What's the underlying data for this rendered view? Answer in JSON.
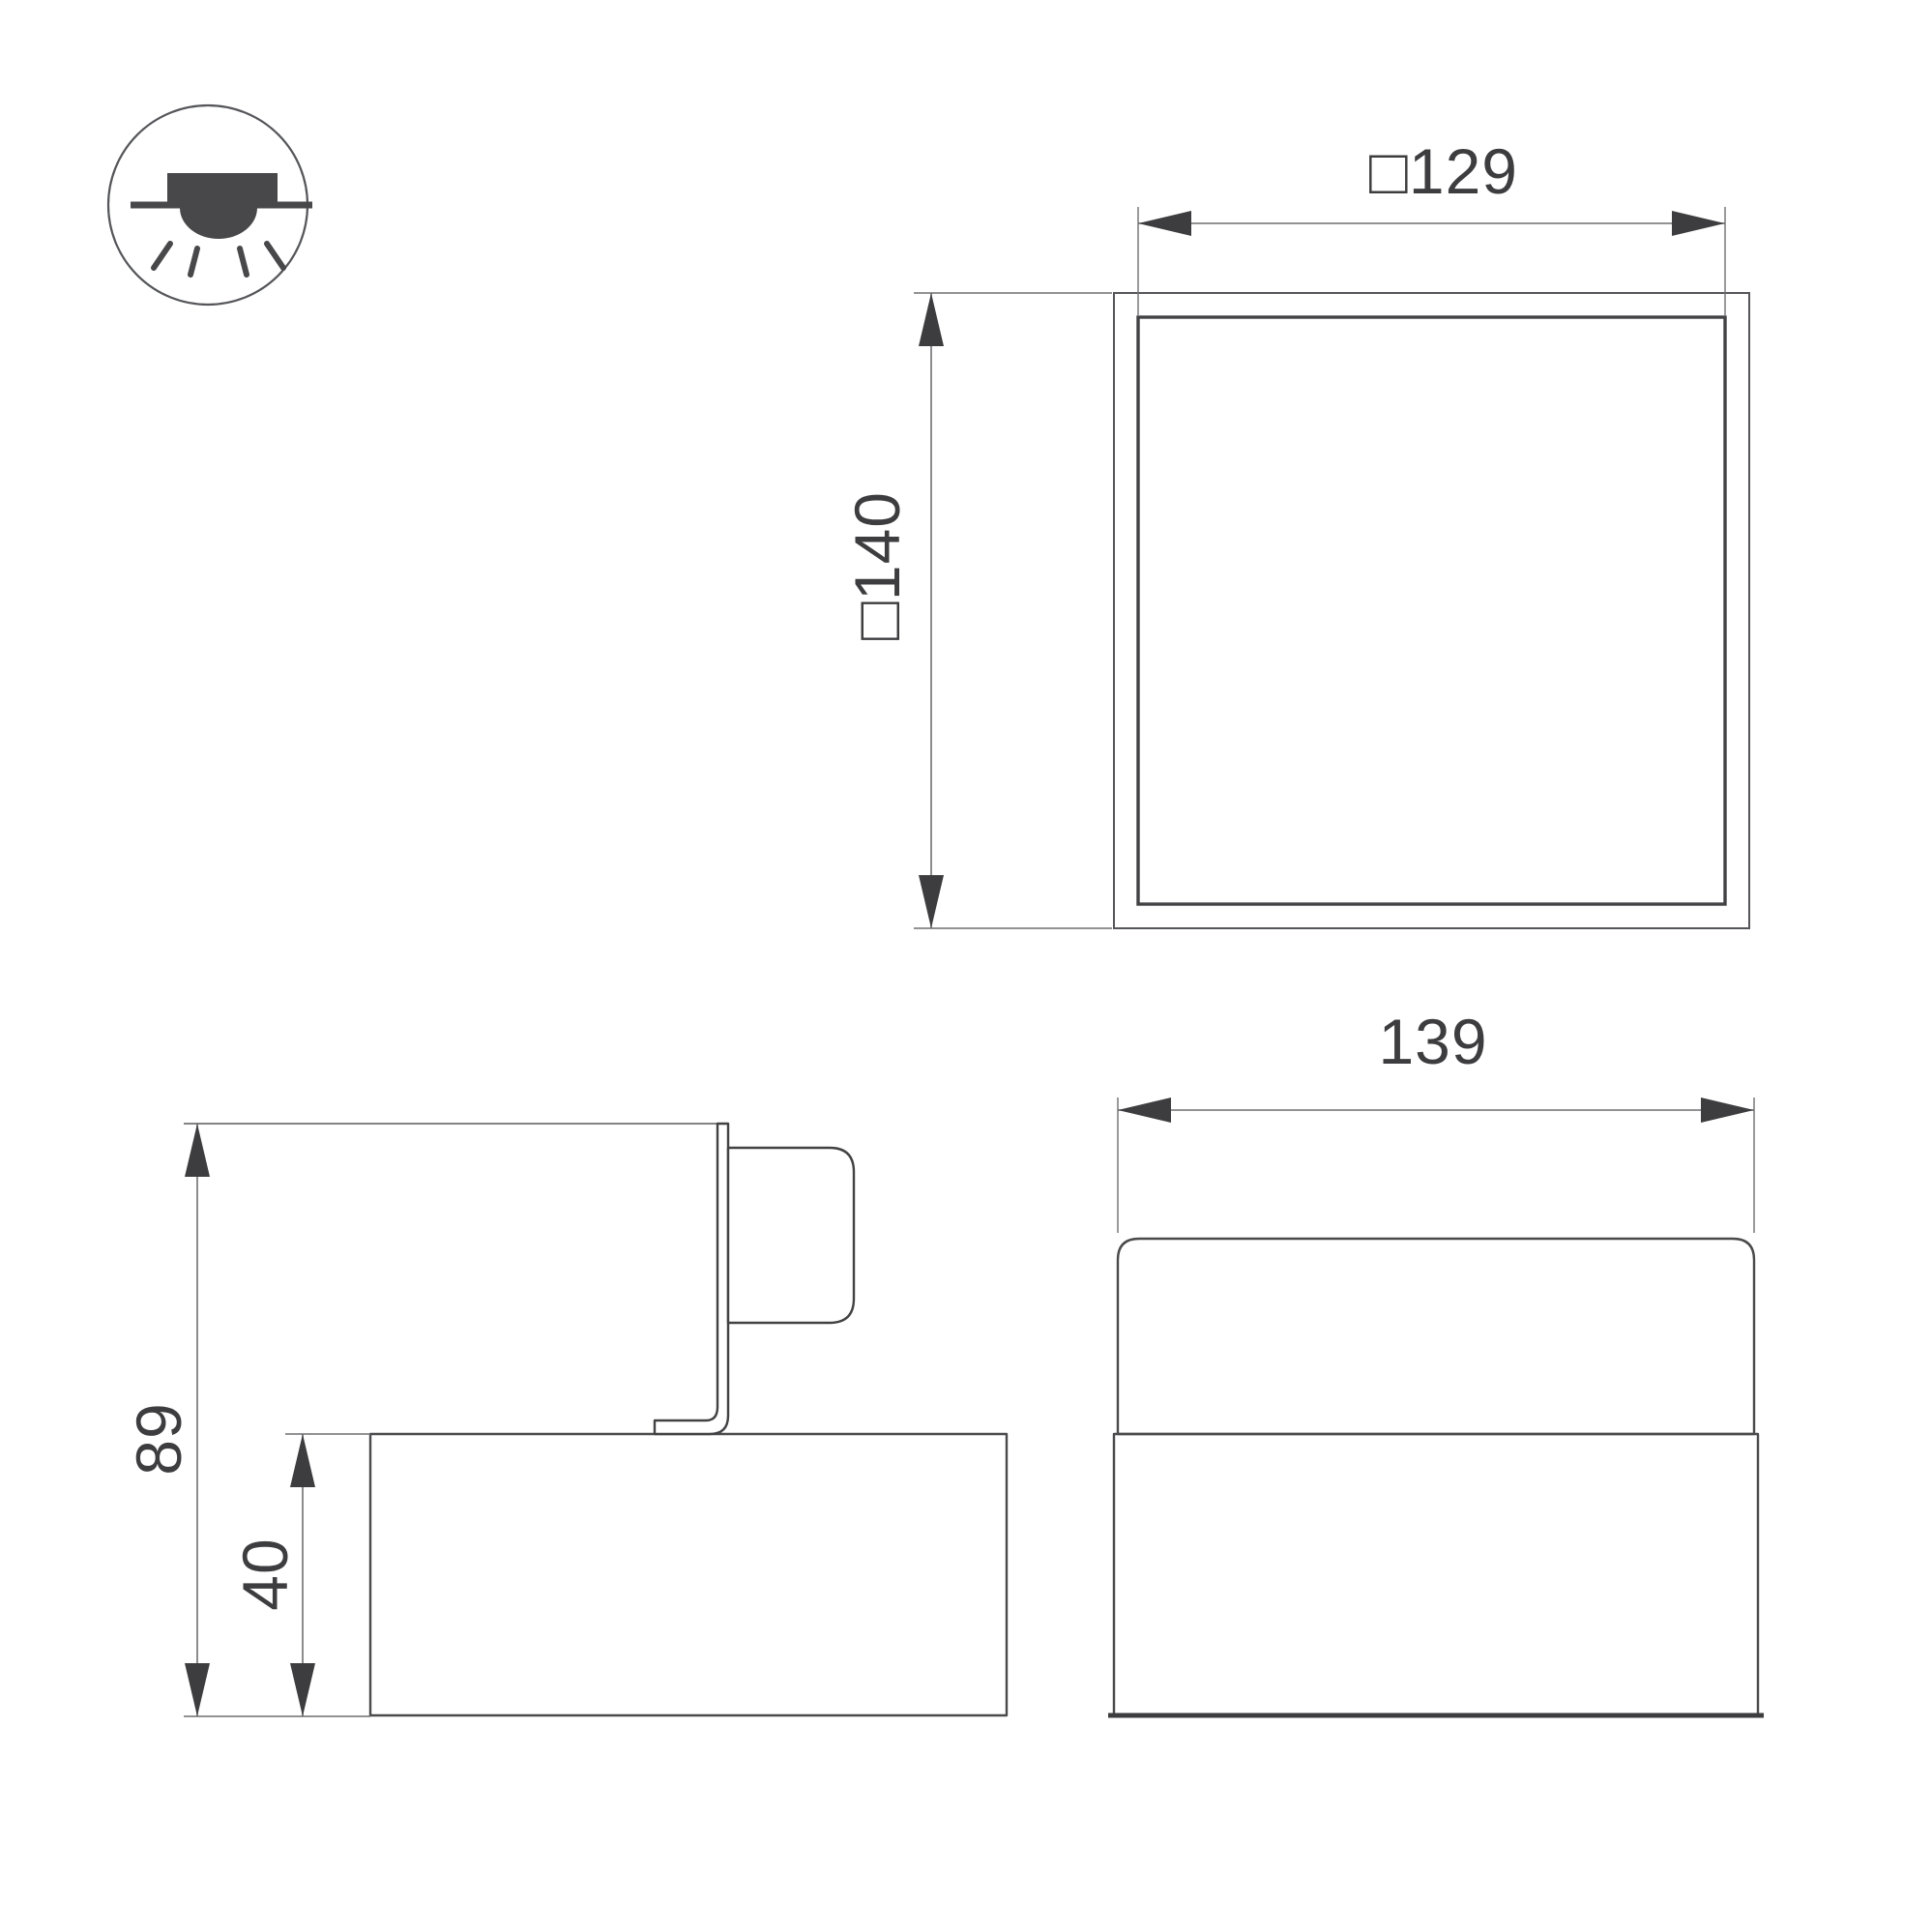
{
  "drawing": {
    "type": "luminaire-dimension-drawing",
    "icon": "recessed-downlight-mounting-icon",
    "views": {
      "top": {
        "cutout_label": "□129",
        "overall_label": "□140"
      },
      "side": {
        "height_label": "89",
        "recess_label": "40"
      },
      "front": {
        "width_label": "139"
      }
    },
    "colors": {
      "geometry_line": "#4a4a4c",
      "dimension_line": "#6f6f71",
      "text": "#3d3d3f",
      "icon_fill": "#48484a",
      "background": "#ffffff"
    }
  }
}
